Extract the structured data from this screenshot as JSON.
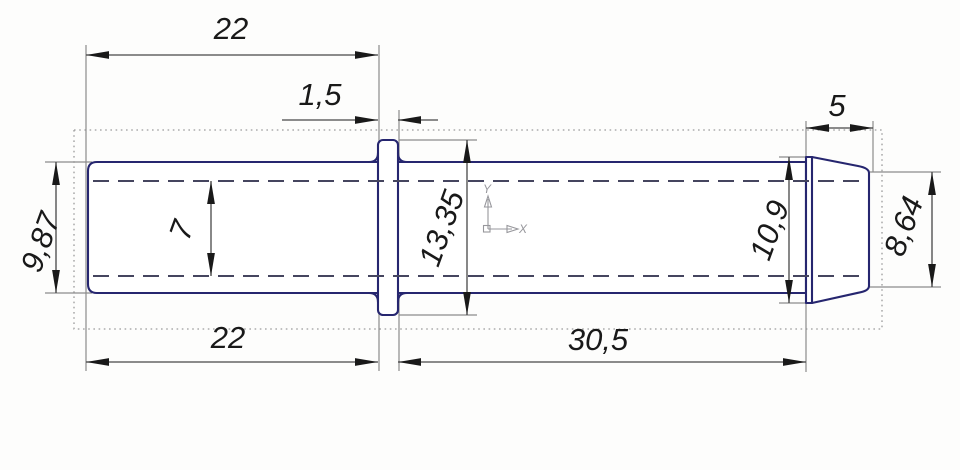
{
  "drawing": {
    "dimensions": {
      "top_length": "22",
      "flange_width": "1,5",
      "tip_length": "5",
      "left_outer_diameter": "9,87",
      "bore_diameter": "7",
      "flange_diameter": "13,35",
      "tip_major_diameter": "10,9",
      "tip_minor_diameter": "8,64",
      "bottom_left_length": "22",
      "body_length": "30,5"
    },
    "axis_marker": {
      "x_label": "X",
      "y_label": "Y"
    },
    "colors": {
      "outline": "#26266f",
      "dimension_line": "#474747",
      "dimension_text": "#191919",
      "extension_line": "#8c8c8c",
      "hidden_line": "#45455f",
      "bounds": "#9b9b9b",
      "ucs": "#97979c",
      "background": "#fdfdfc"
    }
  }
}
